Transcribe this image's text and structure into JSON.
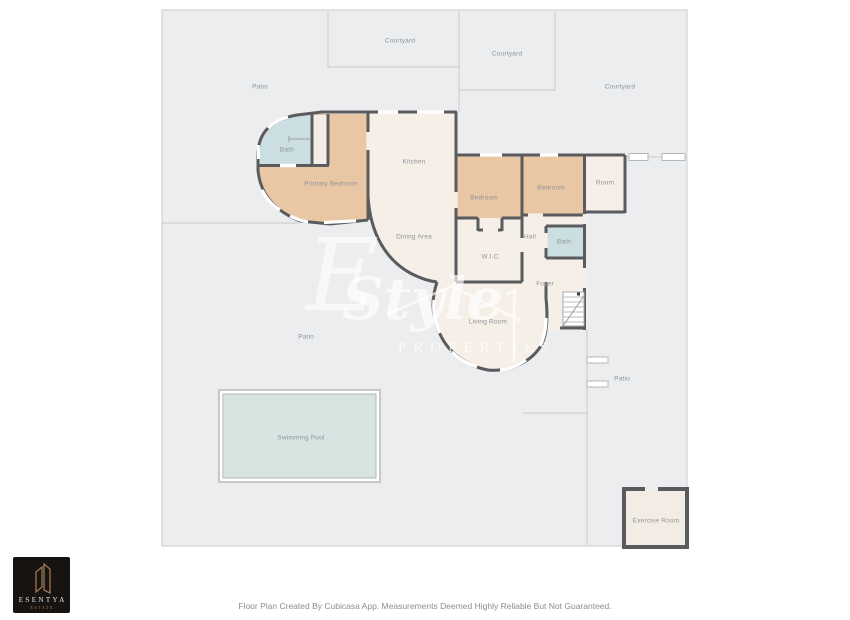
{
  "plan": {
    "background_color": "#ebedee",
    "wall_color": "#5a5b5e",
    "colors": {
      "bedroom_fill": "#eac7a4",
      "living_fill": "#f6efe8",
      "bath_fill": "#cbdfe2",
      "pool_fill": "#d7e4e2",
      "boundary_line": "#c7c9cb"
    },
    "labels": [
      {
        "id": "courtyard-top",
        "text": "Courtyard"
      },
      {
        "id": "courtyard-top-right",
        "text": "Courtyard"
      },
      {
        "id": "patio-top-left",
        "text": "Patio"
      },
      {
        "id": "courtyard-right",
        "text": "Courtyard"
      },
      {
        "id": "bath-1",
        "text": "Bath"
      },
      {
        "id": "kitchen",
        "text": "Kitchen"
      },
      {
        "id": "primary-bedroom",
        "text": "Primary Bedroom"
      },
      {
        "id": "bedroom-1",
        "text": "Bedroom"
      },
      {
        "id": "bedroom-2",
        "text": "Bedroom"
      },
      {
        "id": "room",
        "text": "Room"
      },
      {
        "id": "dining-area",
        "text": "Dining Area"
      },
      {
        "id": "hall",
        "text": "Hall"
      },
      {
        "id": "bath-2",
        "text": "Bath"
      },
      {
        "id": "wic",
        "text": "W.I.C."
      },
      {
        "id": "foyer",
        "text": "Foyer"
      },
      {
        "id": "living-room",
        "text": "Living Room"
      },
      {
        "id": "patio-left",
        "text": "Patio"
      },
      {
        "id": "patio-right",
        "text": "Patio"
      },
      {
        "id": "swimming-pool",
        "text": "Swimming Pool"
      },
      {
        "id": "exercise-room",
        "text": "Exercise Room"
      }
    ]
  },
  "watermark": {
    "initial": "E",
    "script": "Style",
    "caps": "PROPERTIES"
  },
  "logo": {
    "brand": "ESENTYA",
    "subtitle": "ESTATE"
  },
  "footer": {
    "text": "Floor Plan Created By Cubicasa App. Measurements Deemed Highly Reliable But Not Guaranteed."
  }
}
